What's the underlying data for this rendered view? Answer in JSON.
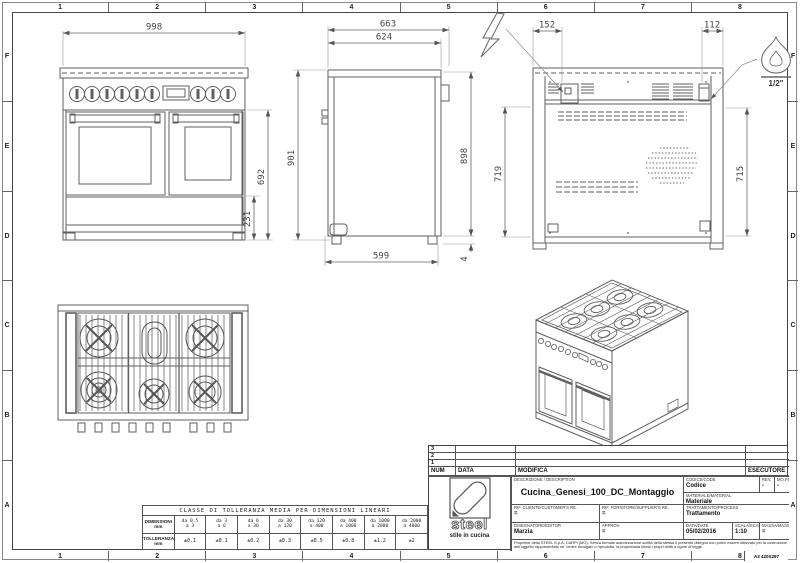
{
  "frame": {
    "cols": [
      "1",
      "2",
      "3",
      "4",
      "5",
      "6",
      "7",
      "8"
    ],
    "rows": [
      "F",
      "E",
      "D",
      "C",
      "B",
      "A"
    ],
    "sheet": "A3 420X297"
  },
  "dims": {
    "front_width": "998",
    "front_body": "692",
    "front_base": "231",
    "total_height": "901",
    "depth_total": "663",
    "depth_body": "624",
    "back_height": "898",
    "base_depth": "599",
    "foot": "4",
    "elec_offset": "152",
    "gas_offset": "112",
    "rear_left": "719",
    "rear_right": "715",
    "gas_size": "1/2\""
  },
  "symbols": {
    "electric": "lightning-bolt",
    "gas": "flame"
  },
  "tolerance": {
    "title": "CLASSE DI TOLLERANZA MEDIA PER DIMENSIONI LINEARI",
    "dim_label": "DIMENSIONI",
    "tol_label": "TOLLERANZA",
    "unit": "mm",
    "range_from": [
      "da 0.5",
      "da 3",
      "da 6",
      "da 30",
      "da 120",
      "da 400",
      "da 1000",
      "da 2000"
    ],
    "range_to": [
      "a 3",
      "a 6",
      "a 30",
      "a 120",
      "a 400",
      "a 1000",
      "a 2000",
      "a 4000"
    ],
    "values": [
      "±0.1",
      "±0.1",
      "±0.2",
      "±0.3",
      "±0.5",
      "±0.8",
      "±1.2",
      "±2"
    ]
  },
  "revisions": {
    "rows": [
      "3",
      "2",
      "1"
    ],
    "num": "NUM",
    "data": "DATA",
    "modifica": "MODIFICA",
    "esecutore": "ESECUTORE"
  },
  "title_block": {
    "description_label": "DESCRIZIONE / DESCRIPTION",
    "description": "Cucina_Genesi_100_DC_Montaggio",
    "code_label": "CODICE/CODE",
    "code": "Codice",
    "rev_label": "REV.",
    "rev": "-",
    "mod_label": "MO.FE.",
    "mod": "-",
    "material_label": "MATERIALE/MATERIAL",
    "material": "Materiale",
    "customer_label": "RIF. CLIENTE/CUSTOMER'S RE.",
    "customer": "=",
    "supplier_label": "RIF. FORNITORE/SUPPLIER'S RE.",
    "supplier": "=",
    "process_label": "TRATTAMENTO/PROCESS",
    "process": "Trattamento",
    "editor_label": "DISEGNATORE/EDITOR",
    "editor": "Marzia",
    "approv_label": "APPROV.",
    "approv": "=",
    "date_label": "DATA/DATE",
    "date": "05/02/2016",
    "scale_label": "SCALA/SCALE",
    "scale": "1:10",
    "mass_label": "MASSA/MASS kg",
    "mass": "=",
    "legal": "Proprieta' della STEEL S.p.A. CARPI (MO). Senza formale autorizzazione scritta della stessa il presente disegno non potra' essere utilizzato per la costruzione dell'oggetto rappresentato ne' venire divulgato o riprodotto, la proprietaria tutela i propri diritti a rigore di legge."
  },
  "logo": {
    "word": "steel",
    "tagline": "stile in cucina"
  }
}
